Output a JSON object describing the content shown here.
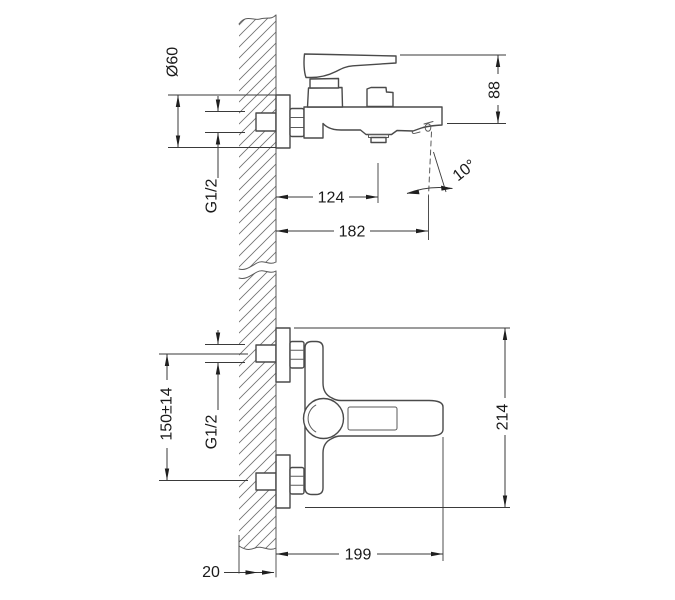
{
  "drawing": {
    "colors": {
      "background": "#ffffff",
      "object_line": "#4a4a4a",
      "dimension_line": "#3a3a3a",
      "text": "#1a1a1a"
    },
    "side_view_dims": {
      "escutcheon_diameter": "Ø60",
      "inlet_thread": "G1/2",
      "wall_to_aerator": "124",
      "wall_to_spout_tip": "182",
      "body_height": "88",
      "spout_angle": "10°"
    },
    "plan_view_dims": {
      "inlet_spacing": "150±14",
      "inlet_thread": "G1/2",
      "overall_span": "214",
      "wall_to_handle_end": "199",
      "wall_thickness": "20"
    }
  }
}
